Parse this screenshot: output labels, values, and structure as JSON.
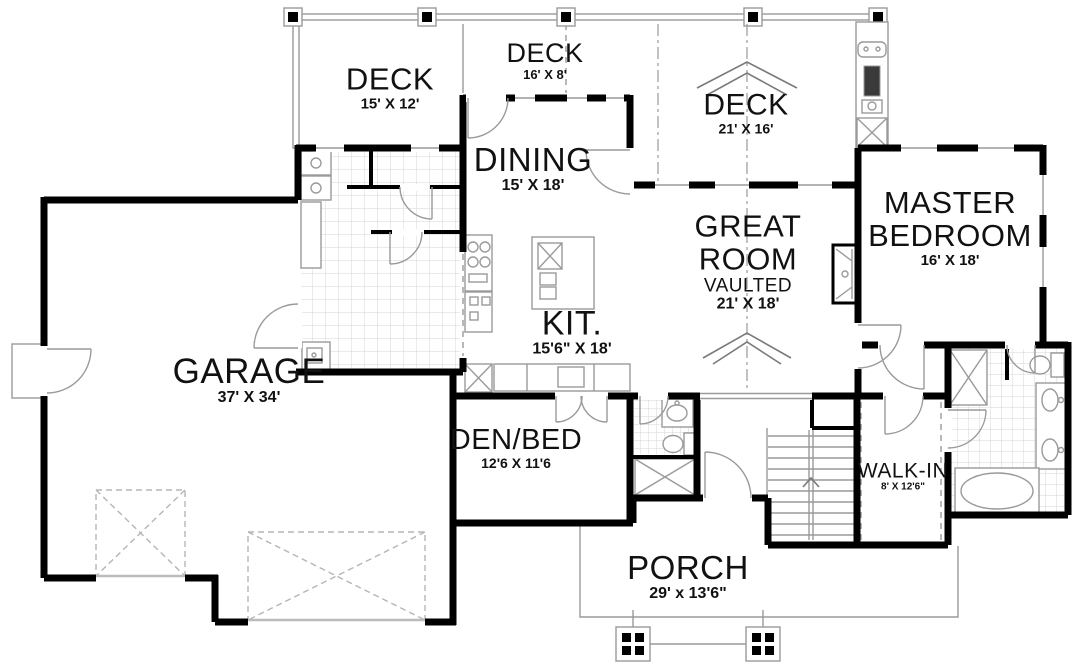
{
  "colors": {
    "wall": "#000000",
    "thin_line": "#9a9a9a",
    "tile_line": "#d5d5d5",
    "dark_fill": "#3a3a3a",
    "text": "#111111",
    "background": "#ffffff"
  },
  "rooms": {
    "deck_left": {
      "name": "DECK",
      "dims": "15' X 12'"
    },
    "deck_mid": {
      "name": "DECK",
      "dims": "16' X 8'"
    },
    "deck_right": {
      "name": "DECK",
      "dims": "21' X 16'"
    },
    "dining": {
      "name": "DINING",
      "dims": "15' X 18'"
    },
    "great_room": {
      "name": "GREAT ROOM",
      "sub": "VAULTED",
      "dims": "21' X 18'"
    },
    "master_bedroom": {
      "name": "MASTER BEDROOM",
      "dims": "16' X 18'"
    },
    "kitchen": {
      "name": "KIT.",
      "dims": "15'6\" X 18'"
    },
    "garage": {
      "name": "GARAGE",
      "dims": "37' X 34'"
    },
    "den_bed": {
      "name": "DEN/BED",
      "dims": "12'6 X 11'6"
    },
    "walk_in": {
      "name": "WALK-IN",
      "dims": "8' X 12'6\""
    },
    "porch": {
      "name": "PORCH",
      "dims": "29' x 13'6\""
    }
  }
}
